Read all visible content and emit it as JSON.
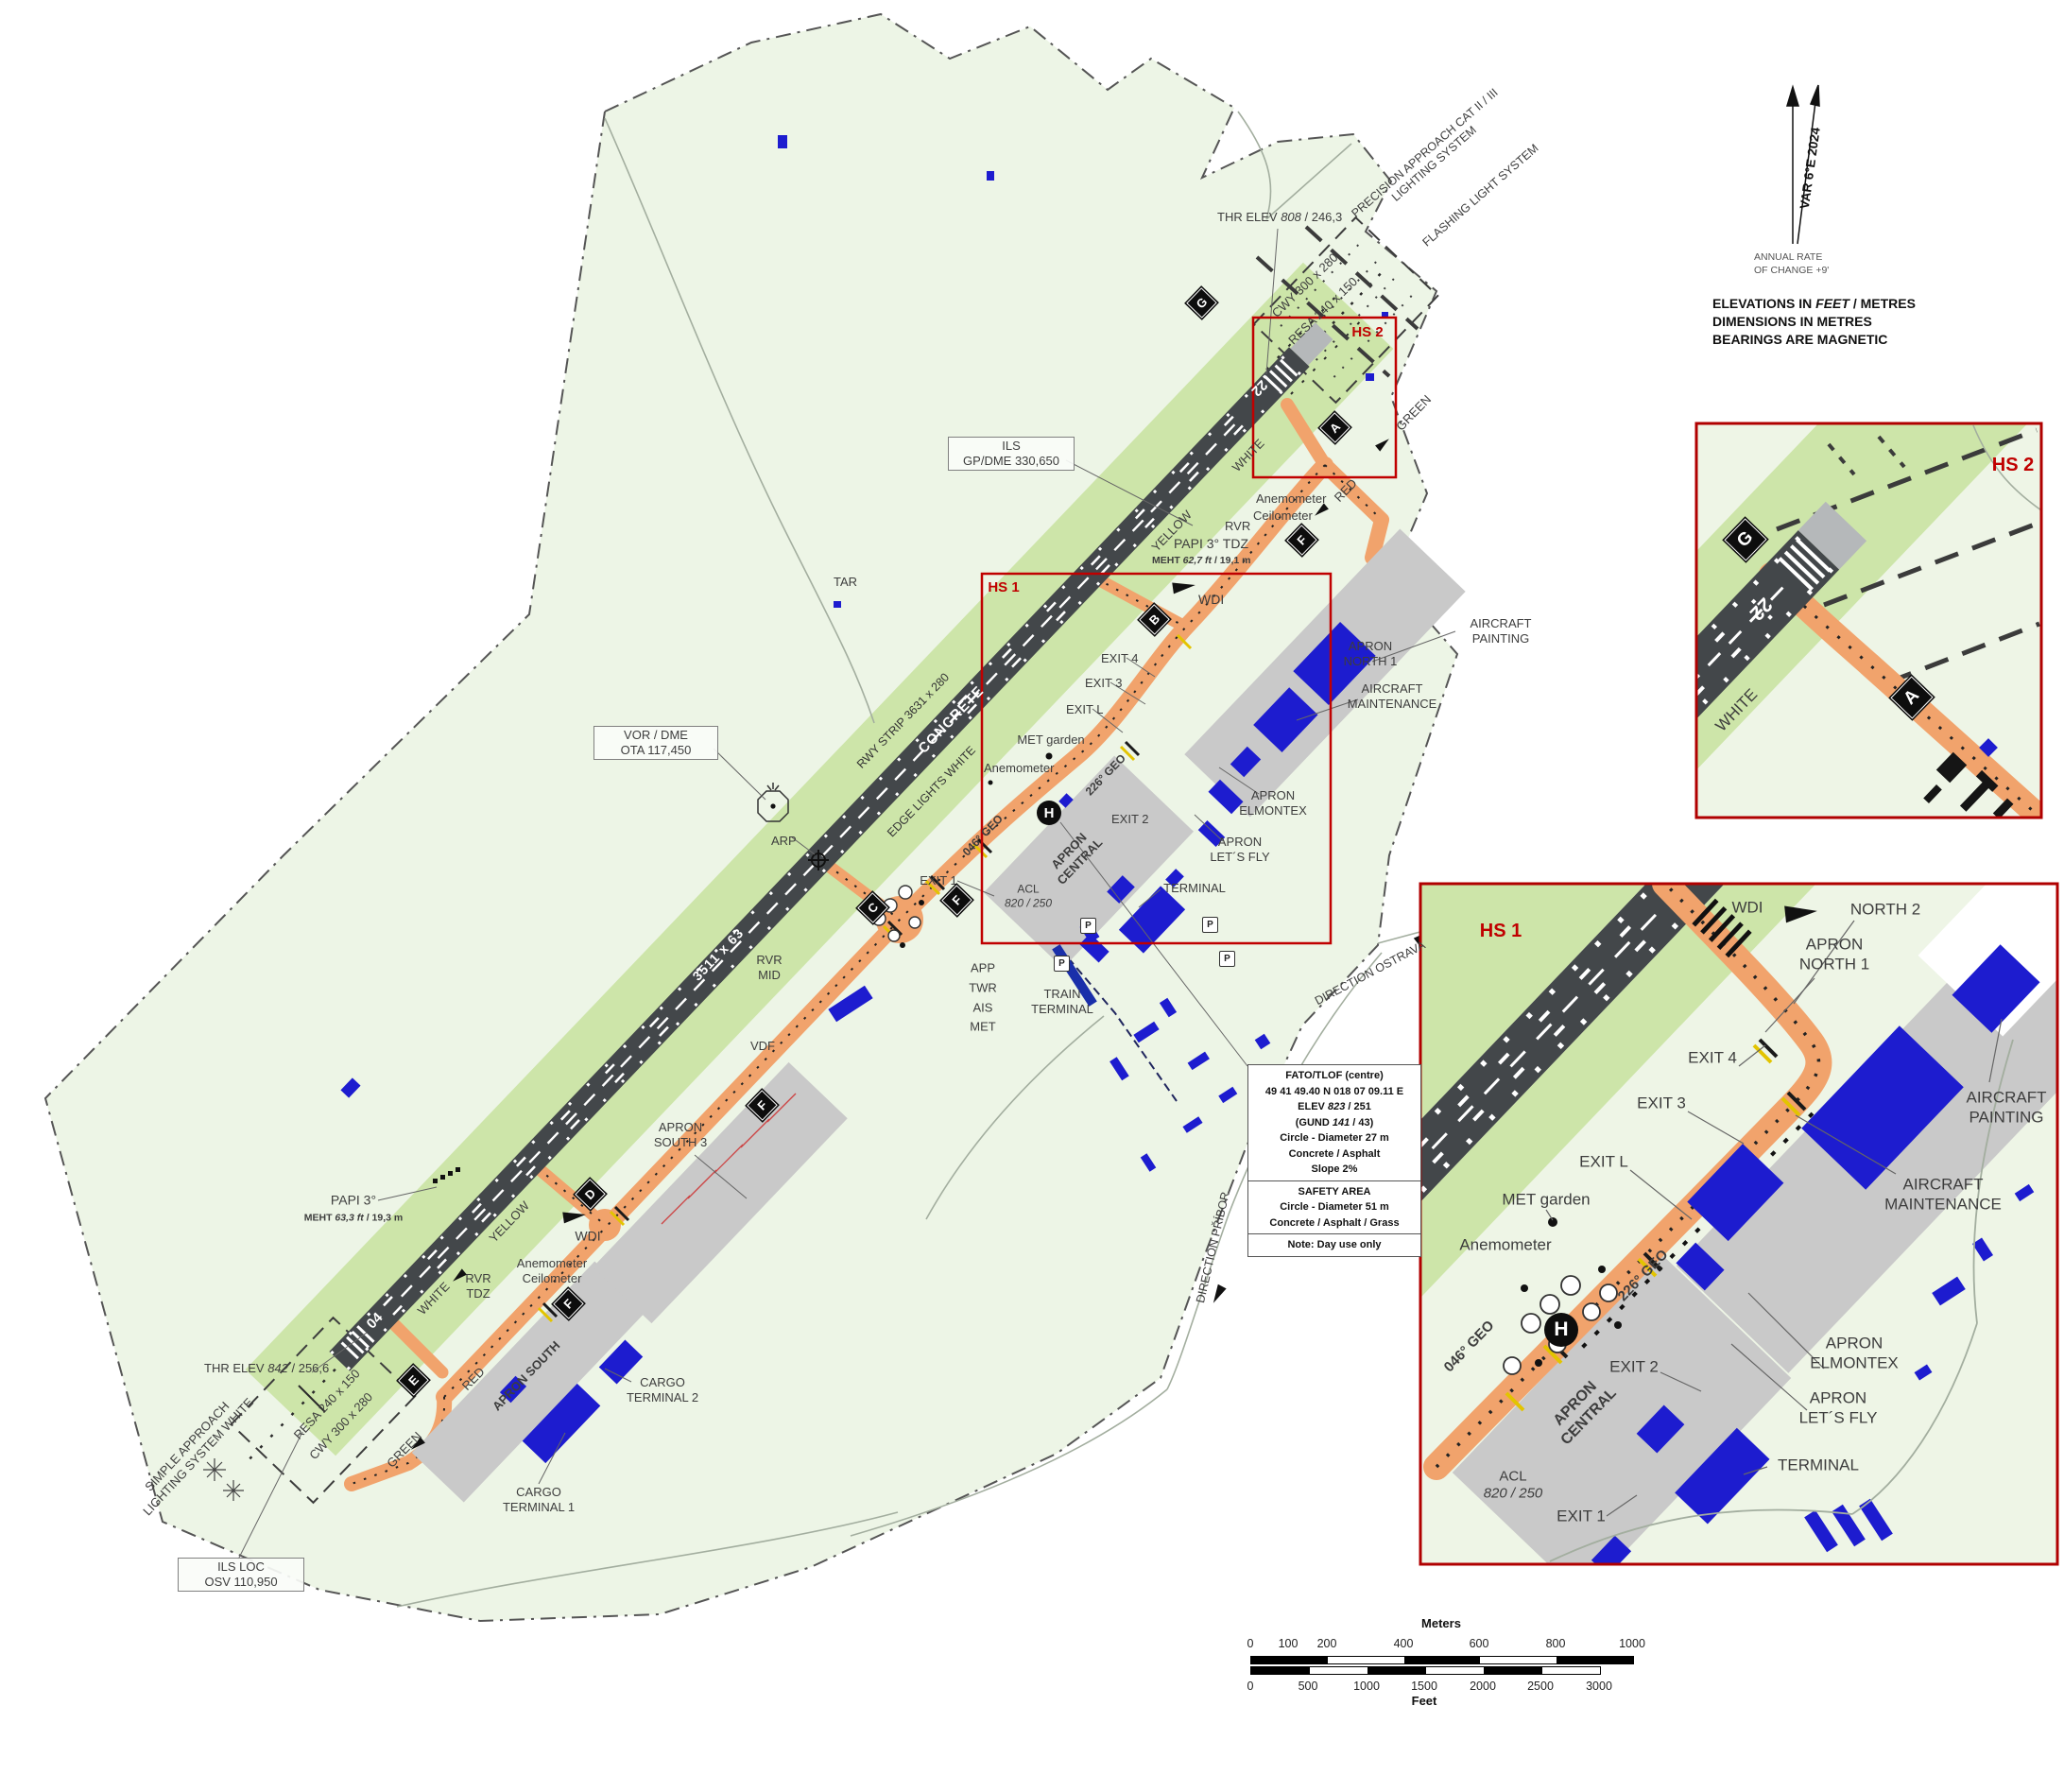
{
  "chart_meta": {
    "type_hint": "aerodrome-chart",
    "colors": {
      "boundary_fill": "#edf5e6",
      "strip_green": "#cde5a9",
      "runway_gray": "#43474a",
      "taxiway_orange": "#f1a36c",
      "apron_gray": "#c9c9c9",
      "building_blue": "#1d1ccf",
      "hs_red": "#c00000"
    }
  },
  "north": {
    "var": "VAR 6°E 2024",
    "rate1": "ANNUAL RATE",
    "rate2": "OF CHANGE +9'",
    "note1a": "ELEVATIONS IN ",
    "note1b": "FEET",
    "note1c": " / METRES",
    "note2": "DIMENSIONS IN METRES",
    "note3": "BEARINGS ARE MAGNETIC"
  },
  "scale": {
    "meters_title": "Meters",
    "feet_title": "Feet",
    "m": [
      "0",
      "100",
      "200",
      "400",
      "600",
      "800",
      "1000"
    ],
    "f": [
      "0",
      "500",
      "1000",
      "1500",
      "2000",
      "2500",
      "3000"
    ]
  },
  "boxes": {
    "ils1": "ILS",
    "ils2": "GP/DME 330,650",
    "vor1": "VOR / DME",
    "vor2": "OTA 117,450",
    "loc1": "ILS LOC",
    "loc2": "OSV 110,950"
  },
  "fato": {
    "t": "FATO/TLOF (centre)",
    "coords": "49 41 49.40 N  018 07 09.11 E",
    "elev_a": "ELEV ",
    "elev_b": "823",
    "elev_c": " / 251",
    "gund_a": "(GUND ",
    "gund_b": "141",
    "gund_c": " / 43)",
    "circle": "Circle - Diameter 27 m",
    "surf": "Concrete / Asphalt",
    "slope": "Slope 2%",
    "sa_t": "SAFETY AREA",
    "sa_circle": "Circle - Diameter 51 m",
    "sa_surf": "Concrete / Asphalt / Grass",
    "note": "Note: Day use only"
  },
  "runway": {
    "n22": "22",
    "n04": "04",
    "dim": "3511 x 63",
    "surface": "CONCRETE",
    "strip": "RWY STRIP 3631 x 280",
    "edge": "EDGE LIGHTS WHITE"
  },
  "signs": {
    "a": "A",
    "b": "B",
    "c": "C",
    "d": "D",
    "e": "E",
    "f": "F",
    "g": "G"
  },
  "hs": {
    "hs1": "HS 1",
    "hs2": "HS 2"
  },
  "dirs": {
    "ostrava": "DIRECTION OSTRAVA",
    "pribor": "DIRECTION PŘÍBOR"
  },
  "labels": {
    "thr22a": "THR ELEV ",
    "thr22b": "808",
    "thr22c": " / 246,3",
    "thr04b": "842",
    "thr04c": " / 256,6",
    "precision1": "PRECISION APPROACH CAT II / III",
    "precision2": "LIGHTING SYSTEM",
    "flashing": "FLASHING LIGHT SYSTEM",
    "cwy": "CWY 300 x 280",
    "resa": "RESA 240 x 150",
    "tar": "TAR",
    "arp": "ARP",
    "anemometer": "Anemometer",
    "ceilometer": "Ceilometer",
    "rvr": "RVR",
    "mid": "MID",
    "tdz": "TDZ",
    "vdf": "VDF",
    "papi_tdz": "PAPI 3° TDZ",
    "papi": "PAPI 3°",
    "meht_a": "MEHT ",
    "meht22b": "62,7 ft",
    "meht22c": " / 19,1 m",
    "meht04b": "63,3 ft",
    "meht04c": " / 19,3 m",
    "wdi": "WDI",
    "exit1": "EXIT 1",
    "exit2": "EXIT 2",
    "exit3": "EXIT 3",
    "exit4": "EXIT 4",
    "exitl": "EXIT L",
    "apron": "APRON",
    "north1": "NORTH 1",
    "north2": "NORTH 2",
    "central": "CENTRAL",
    "aircraft": "AIRCRAFT",
    "maintenance": "MAINTENANCE",
    "painting": "PAINTING",
    "met_garden": "MET garden",
    "geo226": "226° GEO",
    "geo046": "046° GEO",
    "heli": "H",
    "acl": "ACL",
    "acl_v": "820 / 250",
    "elmontex": "ELMONTEX",
    "letsfly": "LET´S FLY",
    "terminal": "TERMINAL",
    "p": "P",
    "app": "APP",
    "twr": "TWR",
    "ais": "AIS",
    "met": "MET",
    "train": "TRAIN",
    "south3": "SOUTH 3",
    "apron_south": "APRON SOUTH",
    "cargo": "CARGO",
    "terminal2": "TERMINAL 2",
    "terminal1": "TERMINAL 1",
    "simple1": "SIMPLE APPROACH",
    "simple2": "LIGHTING SYSTEM WHITE",
    "green": "GREEN",
    "red": "RED",
    "white": "WHITE",
    "yellow": "YELLOW"
  }
}
